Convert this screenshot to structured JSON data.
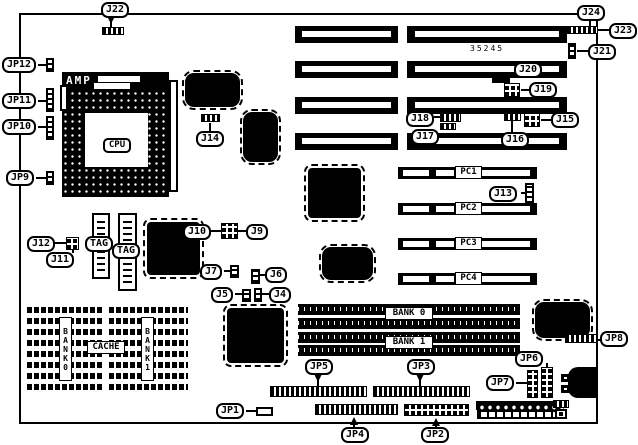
{
  "colors": {
    "ink": "#000000",
    "paper": "#ffffff"
  },
  "board": {
    "part_number": "35245"
  },
  "callouts": {
    "j4": "J4",
    "j5": "J5",
    "j6": "J6",
    "j7": "J7",
    "j9": "J9",
    "j10": "J10",
    "j11": "J11",
    "j12": "J12",
    "j13": "J13",
    "j14": "J14",
    "j15": "J15",
    "j16": "J16",
    "j17": "J17",
    "j18": "J18",
    "j19": "J19",
    "j20": "J20",
    "j21": "J21",
    "j22": "J22",
    "j23": "J23",
    "j24": "J24",
    "jp1": "JP1",
    "jp2": "JP2",
    "jp3": "JP3",
    "jp4": "JP4",
    "jp5": "JP5",
    "jp6": "JP6",
    "jp7": "JP7",
    "jp8": "JP8",
    "jp9": "JP9",
    "jp10": "JP10",
    "jp11": "JP11",
    "jp12": "JP12"
  },
  "chips": {
    "cpu": "CPU",
    "cpu_socket_brand": "AMP",
    "tag": "TAG",
    "cache": "CACHE"
  },
  "memory": {
    "bank0_cache_vertical": "BANK0",
    "bank1_cache_vertical": "BANK1",
    "bank0_simm": "BANK 0",
    "bank1_simm": "BANK 1"
  },
  "pci_slots": [
    "PC1",
    "PC2",
    "PC3",
    "PC4"
  ]
}
